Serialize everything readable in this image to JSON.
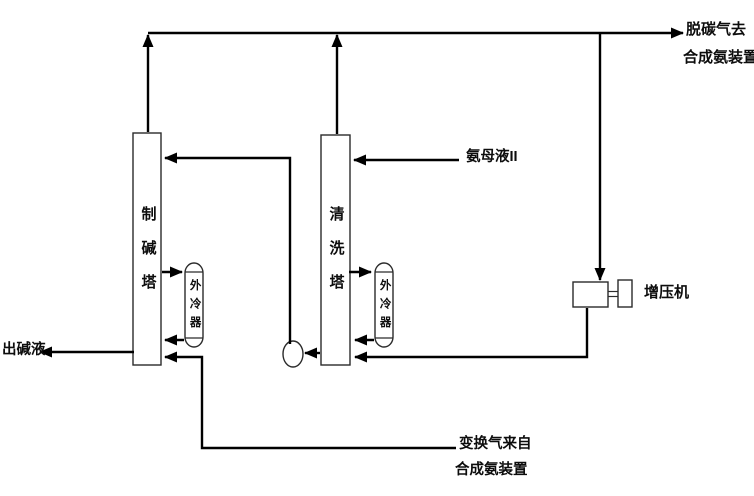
{
  "diagram": {
    "type": "process-flow-diagram",
    "colors": {
      "background": "#ffffff",
      "pipe_line": "#000000",
      "equipment_outline": "#2b2b2b",
      "equipment_fill": "#ffffff",
      "text": "#0d0d0d"
    },
    "equipment": {
      "soda_tower": {
        "label": "制碱塔"
      },
      "washing_tower": {
        "label": "清洗塔"
      },
      "soda_tower_cooler": {
        "label": "外冷器"
      },
      "washing_tower_cooler": {
        "label": "外冷器"
      },
      "booster_compressor": {
        "label": "增压机"
      }
    },
    "streams": {
      "decarbonized_gas_out": {
        "line1": "脱碳气去",
        "line2": "合成氨装置"
      },
      "ammonia_mother_liquor_2": {
        "label": "氨母液II"
      },
      "alkali_liquor_out": {
        "label": "出碱液"
      },
      "shift_gas_in": {
        "line1": "变换气来自",
        "line2": "合成氨装置"
      }
    }
  }
}
